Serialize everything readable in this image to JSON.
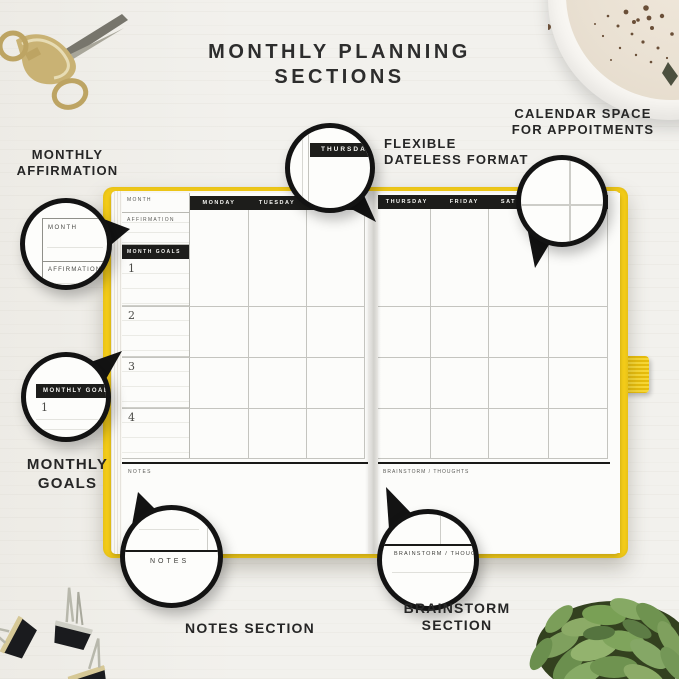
{
  "page": {
    "title_line1": "MONTHLY PLANNING",
    "title_line2": "SECTIONS"
  },
  "callouts": {
    "affirmation": {
      "label1": "MONTHLY",
      "label2": "AFFIRMATION",
      "zoom_month": "MONTH",
      "zoom_affirmation": "AFFIRMATION"
    },
    "goals": {
      "label1": "MONTHLY",
      "label2": "GOALS",
      "zoom_bar": "MONTHLY GOALS",
      "zoom_number": "1"
    },
    "dateless": {
      "label1": "FLEXIBLE",
      "label2": "DATELESS FORMAT",
      "zoom_day": "THURSDAY"
    },
    "calendar": {
      "label1": "CALENDAR SPACE",
      "label2": "FOR APPOITMENTS"
    },
    "notes": {
      "label": "NOTES SECTION",
      "zoom_text": "NOTES"
    },
    "brainstorm": {
      "label1": "BRAINSTORM",
      "label2": "SECTION",
      "zoom_text": "BRAINSTORM / THOUGH"
    }
  },
  "planner": {
    "left": {
      "month_label": "MONTH",
      "affirmation_label": "AFFIRMATION",
      "goals_bar": "MONTH GOALS",
      "goal_numbers": [
        "1",
        "2",
        "3",
        "4"
      ],
      "days": [
        "MONDAY",
        "TUESDAY",
        "WEDNESDAY"
      ],
      "notes_label": "NOTES"
    },
    "right": {
      "days": [
        "THURSDAY",
        "FRIDAY",
        "SATURDAY"
      ],
      "brainstorm_label": "BRAINSTORM / THOUGHTS"
    }
  },
  "colors": {
    "cover_yellow": "#f6ce19",
    "bar_black": "#1d1d1b",
    "ink": "#2d2d2d",
    "background": "#f2f1ed"
  }
}
